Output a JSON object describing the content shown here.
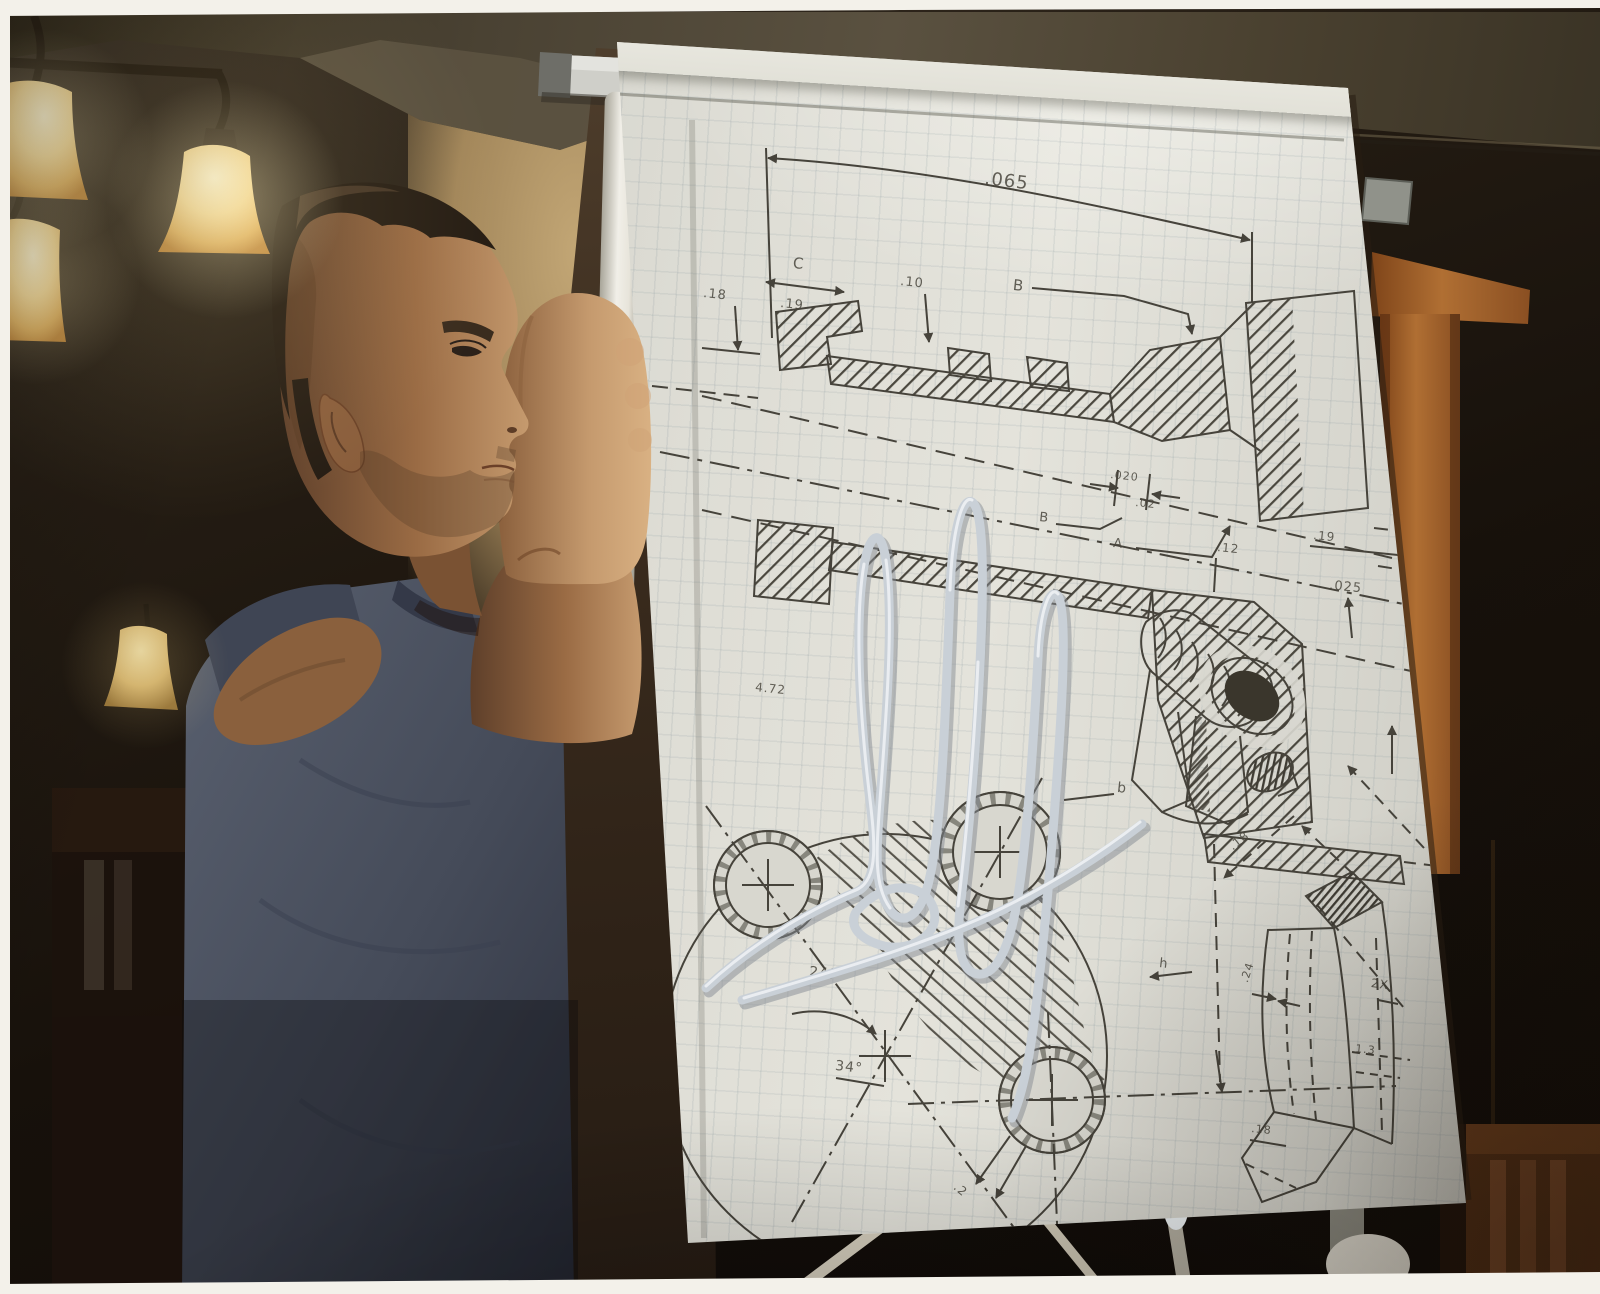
{
  "photo": {
    "kind": "autographed color photo print",
    "width_px": 1600,
    "height_px": 1294
  },
  "palette": {
    "paper": "#d8d7cf",
    "sketch_ink": "#46433b",
    "signature_silver": "#ccd2d8",
    "shirt_slate": "#4b5262",
    "wallpaper_gold": "#c3a265",
    "wood_trim": "#a05c28",
    "room_shadow": "#15100b",
    "lamp_glow": "#f3d795",
    "print_border_white": "#f3f1ea"
  },
  "flipchart_sketch": {
    "labels": [
      {
        "text": ".065"
      },
      {
        "text": "C"
      },
      {
        "text": ".18"
      },
      {
        "text": ".19"
      },
      {
        "text": ".10"
      },
      {
        "text": "B"
      },
      {
        "text": ".020"
      },
      {
        "text": ".02"
      },
      {
        "text": "B"
      },
      {
        "text": "A"
      },
      {
        "text": ".12"
      },
      {
        "text": ".19"
      },
      {
        "text": ".025"
      },
      {
        "text": "24°"
      },
      {
        "text": "34°"
      },
      {
        "text": ".2"
      },
      {
        "text": "4.72"
      },
      {
        "text": "b"
      },
      {
        "text": ".18"
      },
      {
        "text": ".24"
      },
      {
        "text": "h"
      },
      {
        "text": "2X"
      },
      {
        "text": "1.3"
      },
      {
        "text": ".18"
      }
    ]
  }
}
